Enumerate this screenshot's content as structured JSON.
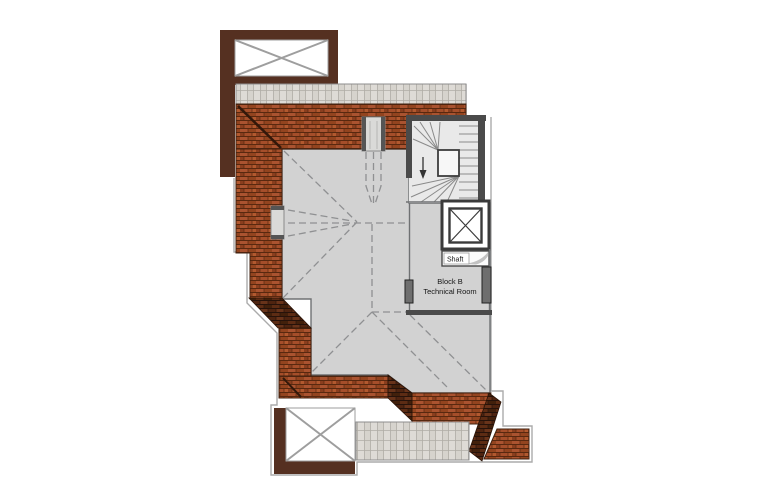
{
  "labels": {
    "shaft": "Shaft",
    "room_line1": "Block B",
    "room_line2": "Technical Room"
  },
  "colors": {
    "background": "#ffffff",
    "brick_roof": "#9c4926",
    "brick_shadow": "#4f2410",
    "paver": "#dedbd6",
    "roof_gray": "#d2d2d2",
    "wall_dark": "#4a4a4a",
    "skylight_frame_brown": "#553021",
    "boundary_line": "#ababab",
    "dashed_line": "#8f9092"
  }
}
